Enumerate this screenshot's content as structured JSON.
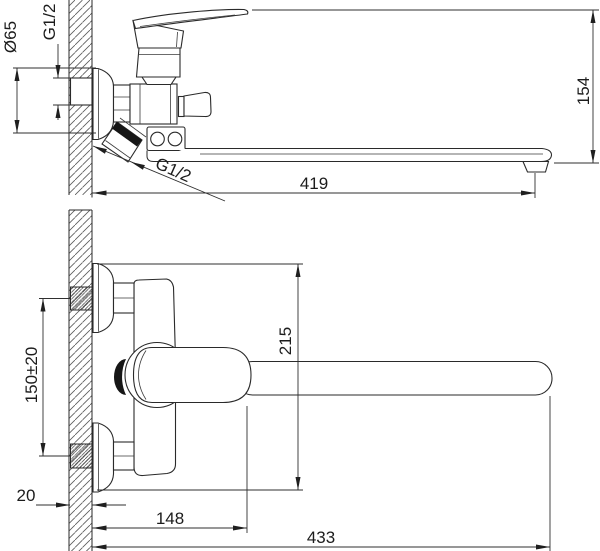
{
  "drawing": {
    "line_color": "#2a2a2a",
    "background_color": "#ffffff",
    "views": {
      "side": {
        "dims": {
          "flange_diameter": "Ø65",
          "inlet_thread": "G1/2",
          "body_height": "154",
          "spout_reach": "419",
          "outlet_thread": "G1/2"
        }
      },
      "plan": {
        "dims": {
          "inlet_spacing": "150±20",
          "overall_width": "215",
          "wall_depth": "20",
          "handle_reach": "148",
          "overall_reach": "433"
        }
      }
    }
  }
}
